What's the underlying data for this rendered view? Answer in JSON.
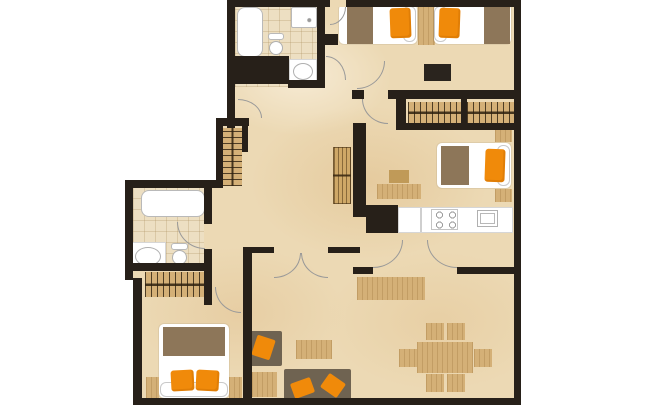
{
  "meta": {
    "title": "apartment-floor-plan",
    "canvas": {
      "width": 645,
      "height": 405,
      "background": "#ffffff"
    }
  },
  "palette": {
    "wall": "#272019",
    "floor": "#ecd9b4",
    "tile": "#eddfc2",
    "wood": "#d4b077",
    "wood-dark": "#c09a58",
    "brown": "#8d7659",
    "sofa": "#6f6351",
    "orange": "#f08a0a",
    "white": "#ffffff",
    "line": "#b9b9b9",
    "arc": "#999999",
    "dark": "#2a241e"
  },
  "rooms": [
    {
      "name": "bathroom-top"
    },
    {
      "name": "bedroom-twin-top-right"
    },
    {
      "name": "walk-in-wardrobe"
    },
    {
      "name": "bedroom-single-right"
    },
    {
      "name": "kitchen"
    },
    {
      "name": "bathroom-left"
    },
    {
      "name": "bedroom-double-bottom-left"
    },
    {
      "name": "living-dining-room"
    },
    {
      "name": "hallway"
    }
  ],
  "elements": [
    {
      "n": "floor-main",
      "k": "floor-main",
      "x": 133,
      "y": 5,
      "w": 381,
      "h": 395
    },
    {
      "n": "outside-mask-top-left",
      "k": "mask",
      "x": 0,
      "y": 0,
      "w": 227,
      "h": 118
    },
    {
      "n": "outside-mask-mid-left",
      "k": "mask",
      "x": 0,
      "y": 118,
      "w": 216,
      "h": 62
    },
    {
      "n": "outside-mask-left",
      "k": "mask",
      "x": 0,
      "y": 180,
      "w": 128,
      "h": 100
    },
    {
      "n": "outside-mask-bottom-left",
      "k": "mask",
      "x": 0,
      "y": 278,
      "w": 133,
      "h": 127
    },
    {
      "n": "bathroom-top-floor",
      "k": "floor-tile",
      "x": 235,
      "y": 5,
      "w": 82,
      "h": 82
    },
    {
      "n": "bathroom-left-floor",
      "k": "floor-tile",
      "x": 133,
      "y": 186,
      "w": 71,
      "h": 79
    },
    {
      "n": "bathtub-top",
      "k": "fixture rounded-lg",
      "x": 237,
      "y": 7,
      "w": 26,
      "h": 50
    },
    {
      "n": "shower-tray",
      "k": "shower",
      "x": 291,
      "y": 7,
      "w": 26,
      "h": 21
    },
    {
      "n": "toilet-tank-top",
      "k": "fixture",
      "x": 268,
      "y": 33,
      "w": 16,
      "h": 7
    },
    {
      "n": "toilet-bowl-top",
      "k": "oval",
      "x": 269,
      "y": 41,
      "w": 14,
      "h": 14
    },
    {
      "n": "sink-counter-top",
      "k": "counter",
      "x": 289,
      "y": 59,
      "w": 28,
      "h": 25
    },
    {
      "n": "sink-basin-top",
      "k": "oval",
      "x": 293,
      "y": 63,
      "w": 20,
      "h": 17
    },
    {
      "n": "closet-hangers-hall",
      "k": "hanger-v",
      "x": 223,
      "y": 128,
      "w": 19,
      "h": 58
    },
    {
      "n": "bathtub-left",
      "k": "fixture rounded-lg",
      "x": 141,
      "y": 190,
      "w": 64,
      "h": 27
    },
    {
      "n": "sink-counter-left",
      "k": "counter",
      "x": 131,
      "y": 242,
      "w": 35,
      "h": 28
    },
    {
      "n": "sink-basin-left",
      "k": "oval",
      "x": 135,
      "y": 247,
      "w": 26,
      "h": 19
    },
    {
      "n": "toilet-tank-left",
      "k": "fixture",
      "x": 171,
      "y": 243,
      "w": 17,
      "h": 7
    },
    {
      "n": "toilet-bowl-left",
      "k": "oval",
      "x": 172,
      "y": 250,
      "w": 15,
      "h": 15
    },
    {
      "n": "wardrobe-hangers-left",
      "k": "hanger-h",
      "x": 145,
      "y": 272,
      "w": 60,
      "h": 25
    },
    {
      "n": "double-bed-base",
      "k": "bed",
      "x": 159,
      "y": 324,
      "w": 70,
      "h": 74
    },
    {
      "n": "double-bed-blanket",
      "k": "brown",
      "x": 163,
      "y": 327,
      "w": 62,
      "h": 29
    },
    {
      "n": "double-bed-headboard",
      "k": "bed-edge",
      "x": 160,
      "y": 382,
      "w": 68,
      "h": 15
    },
    {
      "n": "double-bed-pillow-left",
      "k": "pillow",
      "x": 171,
      "y": 370,
      "w": 23,
      "h": 21,
      "r": -3
    },
    {
      "n": "double-bed-pillow-right",
      "k": "pillow",
      "x": 196,
      "y": 370,
      "w": 23,
      "h": 21,
      "r": 3
    },
    {
      "n": "nightstand-bl-left",
      "k": "wood",
      "x": 146,
      "y": 377,
      "w": 13,
      "h": 21
    },
    {
      "n": "nightstand-bl-right",
      "k": "wood",
      "x": 229,
      "y": 377,
      "w": 13,
      "h": 21
    },
    {
      "n": "twin-bed-1-base",
      "k": "bed",
      "x": 339,
      "y": 4,
      "w": 78,
      "h": 40
    },
    {
      "n": "twin-bed-1-headboard",
      "k": "bed-edge",
      "x": 403,
      "y": 6,
      "w": 13,
      "h": 36
    },
    {
      "n": "twin-bed-1-blanket",
      "k": "brown",
      "x": 347,
      "y": 4,
      "w": 26,
      "h": 40
    },
    {
      "n": "twin-bed-1-pillow",
      "k": "pillow",
      "x": 390,
      "y": 8,
      "w": 21,
      "h": 30,
      "r": -2
    },
    {
      "n": "nightstand-center-top",
      "k": "wood",
      "x": 418,
      "y": 3,
      "w": 17,
      "h": 42
    },
    {
      "n": "twin-bed-2-base",
      "k": "bed",
      "x": 434,
      "y": 4,
      "w": 77,
      "h": 40
    },
    {
      "n": "twin-bed-2-headboard",
      "k": "bed-edge",
      "x": 434,
      "y": 6,
      "w": 13,
      "h": 36
    },
    {
      "n": "twin-bed-2-blanket",
      "k": "brown",
      "x": 484,
      "y": 4,
      "w": 26,
      "h": 40
    },
    {
      "n": "twin-bed-2-pillow",
      "k": "pillow",
      "x": 439,
      "y": 8,
      "w": 21,
      "h": 30,
      "r": 2
    },
    {
      "n": "tv-dresser",
      "k": "dark",
      "x": 424,
      "y": 64,
      "w": 27,
      "h": 17
    },
    {
      "n": "wardrobe-hangers-right-1",
      "k": "hanger-h",
      "x": 408,
      "y": 102,
      "w": 54,
      "h": 21
    },
    {
      "n": "wardrobe-hangers-right-2",
      "k": "hanger-h",
      "x": 467,
      "y": 102,
      "w": 51,
      "h": 21
    },
    {
      "n": "nightstand-mr-top",
      "k": "wood",
      "x": 495,
      "y": 129,
      "w": 17,
      "h": 13
    },
    {
      "n": "single-bed-base",
      "k": "bed",
      "x": 437,
      "y": 143,
      "w": 74,
      "h": 45
    },
    {
      "n": "single-bed-headboard",
      "k": "bed-edge",
      "x": 497,
      "y": 145,
      "w": 13,
      "h": 41
    },
    {
      "n": "single-bed-blanket",
      "k": "brown",
      "x": 441,
      "y": 146,
      "w": 28,
      "h": 39
    },
    {
      "n": "single-bed-pillow",
      "k": "pillow",
      "x": 485,
      "y": 149,
      "w": 20,
      "h": 33,
      "r": 2
    },
    {
      "n": "nightstand-mr-bottom",
      "k": "wood",
      "x": 495,
      "y": 189,
      "w": 17,
      "h": 13
    },
    {
      "n": "desk",
      "k": "wood",
      "x": 377,
      "y": 184,
      "w": 44,
      "h": 15
    },
    {
      "n": "desk-stool",
      "k": "wood-dark",
      "x": 389,
      "y": 170,
      "w": 20,
      "h": 13
    },
    {
      "n": "shelf-louver",
      "k": "louver",
      "x": 333,
      "y": 147,
      "w": 18,
      "h": 57
    },
    {
      "n": "kitchen-counter",
      "k": "counter",
      "x": 398,
      "y": 207,
      "w": 115,
      "h": 26
    },
    {
      "n": "kitchen-counter-divider",
      "k": "divider",
      "x": 420,
      "y": 208,
      "w": 2,
      "h": 24
    },
    {
      "n": "stove-burners",
      "k": "burners",
      "x": 431,
      "y": 209,
      "w": 27,
      "h": 21
    },
    {
      "n": "kitchen-sink",
      "k": "inset",
      "x": 477,
      "y": 210,
      "w": 21,
      "h": 17
    },
    {
      "n": "sideboard",
      "k": "wood",
      "x": 357,
      "y": 277,
      "w": 68,
      "h": 23
    },
    {
      "n": "sofa-side",
      "k": "sofa",
      "x": 249,
      "y": 331,
      "w": 33,
      "h": 35
    },
    {
      "n": "sofa-side-cushion",
      "k": "diamond",
      "x": 254,
      "y": 337,
      "w": 19,
      "h": 21,
      "r": 18
    },
    {
      "n": "ottoman",
      "k": "wood",
      "x": 252,
      "y": 372,
      "w": 25,
      "h": 25
    },
    {
      "n": "coffee-table",
      "k": "wood",
      "x": 296,
      "y": 340,
      "w": 36,
      "h": 19
    },
    {
      "n": "sofa-main",
      "k": "sofa",
      "x": 284,
      "y": 369,
      "w": 67,
      "h": 34
    },
    {
      "n": "sofa-main-cushion-1",
      "k": "diamond",
      "x": 292,
      "y": 380,
      "w": 21,
      "h": 16,
      "r": -20
    },
    {
      "n": "sofa-main-cushion-2",
      "k": "diamond",
      "x": 323,
      "y": 377,
      "w": 20,
      "h": 17,
      "r": 35
    },
    {
      "n": "dining-table",
      "k": "wood",
      "x": 417,
      "y": 342,
      "w": 56,
      "h": 31
    },
    {
      "n": "dining-chair-top-1",
      "k": "wood",
      "x": 426,
      "y": 323,
      "w": 18,
      "h": 17
    },
    {
      "n": "dining-chair-top-2",
      "k": "wood",
      "x": 447,
      "y": 323,
      "w": 18,
      "h": 17
    },
    {
      "n": "dining-chair-left",
      "k": "wood",
      "x": 399,
      "y": 349,
      "w": 18,
      "h": 18
    },
    {
      "n": "dining-chair-right",
      "k": "wood",
      "x": 474,
      "y": 349,
      "w": 18,
      "h": 18
    },
    {
      "n": "dining-chair-bottom-1",
      "k": "wood",
      "x": 426,
      "y": 374,
      "w": 18,
      "h": 18
    },
    {
      "n": "dining-chair-bottom-2",
      "k": "wood",
      "x": 447,
      "y": 374,
      "w": 18,
      "h": 18
    },
    {
      "n": "door-arc-bathroom-top",
      "k": "arc",
      "c": "tr",
      "x": 326,
      "y": 56,
      "w": 20,
      "h": 24
    },
    {
      "n": "door-arc-hall-upper",
      "k": "arc",
      "c": "tr",
      "x": 238,
      "y": 99,
      "w": 24,
      "h": 19
    },
    {
      "n": "door-arc-bedroom-top",
      "k": "arc",
      "c": "br",
      "x": 357,
      "y": 61,
      "w": 28,
      "h": 28
    },
    {
      "n": "door-arc-bedroom-right",
      "k": "arc",
      "c": "bl",
      "x": 362,
      "y": 99,
      "w": 26,
      "h": 25
    },
    {
      "n": "door-arc-bathroom-left",
      "k": "arc",
      "c": "bl",
      "x": 177,
      "y": 222,
      "w": 28,
      "h": 27
    },
    {
      "n": "door-arc-bedroom-bl",
      "k": "arc",
      "c": "bl",
      "x": 215,
      "y": 287,
      "w": 26,
      "h": 26
    },
    {
      "n": "door-arc-living-left",
      "k": "arc",
      "c": "br",
      "x": 274,
      "y": 253,
      "w": 27,
      "h": 25
    },
    {
      "n": "door-arc-living-right",
      "k": "arc",
      "c": "bl",
      "x": 301,
      "y": 253,
      "w": 27,
      "h": 25
    },
    {
      "n": "door-arc-kitchen-left",
      "k": "arc",
      "c": "br",
      "x": 373,
      "y": 240,
      "w": 30,
      "h": 28
    },
    {
      "n": "door-arc-kitchen-right",
      "k": "arc",
      "c": "bl",
      "x": 427,
      "y": 240,
      "w": 30,
      "h": 28
    },
    {
      "n": "door-arc-entry",
      "k": "arc",
      "c": "br",
      "x": 330,
      "y": 7,
      "w": 16,
      "h": 18
    },
    {
      "n": "wall-top",
      "k": "wall",
      "x": 227,
      "y": 0,
      "w": 294,
      "h": 7
    },
    {
      "n": "wall-right",
      "k": "wall",
      "x": 514,
      "y": 0,
      "w": 7,
      "h": 405
    },
    {
      "n": "wall-bottom",
      "k": "wall",
      "x": 135,
      "y": 398,
      "w": 386,
      "h": 7
    },
    {
      "n": "wall-bath-top-left",
      "k": "wall",
      "x": 227,
      "y": 0,
      "w": 8,
      "h": 62
    },
    {
      "n": "wall-bath-top-block",
      "k": "wall",
      "x": 227,
      "y": 56,
      "w": 62,
      "h": 28
    },
    {
      "n": "wall-left-upper-seg",
      "k": "wall",
      "x": 227,
      "y": 84,
      "w": 8,
      "h": 44
    },
    {
      "n": "wall-closet-top",
      "k": "wall",
      "x": 216,
      "y": 118,
      "w": 33,
      "h": 8
    },
    {
      "n": "wall-closet-left",
      "k": "wall",
      "x": 216,
      "y": 126,
      "w": 7,
      "h": 62
    },
    {
      "n": "wall-closet-right",
      "k": "wall",
      "x": 242,
      "y": 118,
      "w": 6,
      "h": 34
    },
    {
      "n": "wall-bath-top-right",
      "k": "wall",
      "x": 317,
      "y": 7,
      "w": 8,
      "h": 81
    },
    {
      "n": "wall-corridor-stub",
      "k": "wall",
      "x": 325,
      "y": 34,
      "w": 13,
      "h": 11
    },
    {
      "n": "wall-sink-nook-bottom",
      "k": "wall",
      "x": 288,
      "y": 80,
      "w": 37,
      "h": 8
    },
    {
      "n": "wall-bath-left-top",
      "k": "wall",
      "x": 125,
      "y": 180,
      "w": 93,
      "h": 8
    },
    {
      "n": "wall-left-mid",
      "k": "wall",
      "x": 125,
      "y": 180,
      "w": 8,
      "h": 100
    },
    {
      "n": "wall-left-lower",
      "k": "wall",
      "x": 133,
      "y": 278,
      "w": 9,
      "h": 127
    },
    {
      "n": "wall-bath-left-right-1",
      "k": "wall",
      "x": 204,
      "y": 180,
      "w": 8,
      "h": 44
    },
    {
      "n": "wall-bath-left-right-2",
      "k": "wall",
      "x": 204,
      "y": 249,
      "w": 8,
      "h": 56
    },
    {
      "n": "wall-bath-left-bottom",
      "k": "wall",
      "x": 130,
      "y": 263,
      "w": 78,
      "h": 8
    },
    {
      "n": "wall-bedroom-bl-right",
      "k": "wall",
      "x": 243,
      "y": 247,
      "w": 9,
      "h": 158
    },
    {
      "n": "wall-hall-bottom-left",
      "k": "wall",
      "x": 243,
      "y": 247,
      "w": 31,
      "h": 6
    },
    {
      "n": "wall-hall-bottom-right",
      "k": "wall",
      "x": 328,
      "y": 247,
      "w": 32,
      "h": 6
    },
    {
      "n": "wall-center-vertical",
      "k": "wall",
      "x": 353,
      "y": 123,
      "w": 13,
      "h": 94
    },
    {
      "n": "wall-kitchen-chunk",
      "k": "wall",
      "x": 366,
      "y": 205,
      "w": 32,
      "h": 28
    },
    {
      "n": "wall-mid-horizontal-1",
      "k": "wall",
      "x": 352,
      "y": 90,
      "w": 12,
      "h": 9
    },
    {
      "n": "wall-mid-horizontal-2",
      "k": "wall",
      "x": 388,
      "y": 90,
      "w": 133,
      "h": 9
    },
    {
      "n": "wall-wardrobe-left",
      "k": "wall",
      "x": 396,
      "y": 99,
      "w": 10,
      "h": 31
    },
    {
      "n": "wall-wardrobe-bottom",
      "k": "wall",
      "x": 396,
      "y": 123,
      "w": 125,
      "h": 7
    },
    {
      "n": "wall-wardrobe-divider",
      "k": "wall",
      "x": 461,
      "y": 99,
      "w": 6,
      "h": 26
    },
    {
      "n": "wall-kitchen-bottom-left",
      "k": "wall",
      "x": 353,
      "y": 267,
      "w": 20,
      "h": 7
    },
    {
      "n": "wall-kitchen-bottom-right",
      "k": "wall",
      "x": 457,
      "y": 267,
      "w": 64,
      "h": 7
    },
    {
      "n": "entry-opening",
      "k": "floor-plain",
      "x": 330,
      "y": 0,
      "w": 16,
      "h": 7
    }
  ]
}
